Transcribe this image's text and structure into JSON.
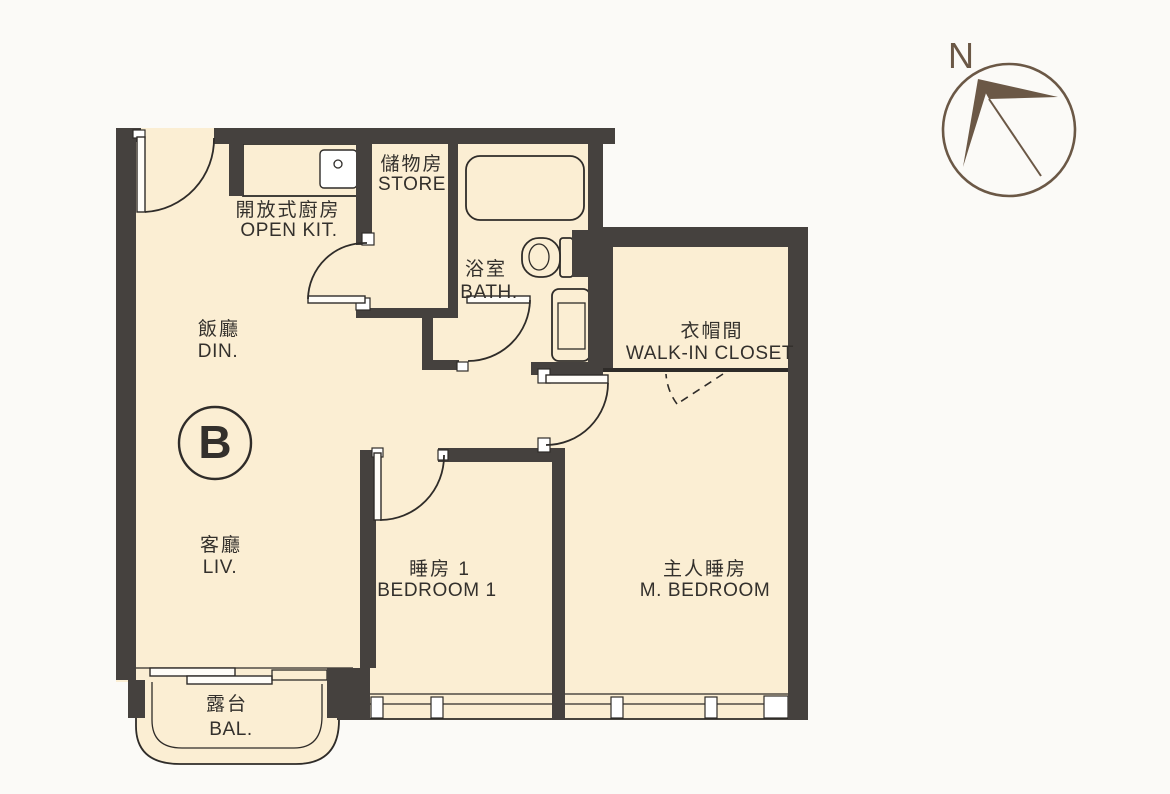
{
  "figure_type": "apartment-floor-plan",
  "unit": {
    "label": "B"
  },
  "compass": {
    "north_label": "N"
  },
  "rooms": {
    "open_kitchen": {
      "cjk": "開放式廚房",
      "en": "OPEN KIT."
    },
    "store": {
      "cjk": "儲物房",
      "en": "STORE"
    },
    "bath": {
      "cjk": "浴室",
      "en": "BATH."
    },
    "walk_in_closet": {
      "cjk": "衣帽間",
      "en": "WALK-IN CLOSET"
    },
    "dining": {
      "cjk": "飯廳",
      "en": "DIN."
    },
    "living": {
      "cjk": "客廳",
      "en": "LIV."
    },
    "bedroom1": {
      "cjk": "睡房 1",
      "en": "BEDROOM 1"
    },
    "master_bedroom": {
      "cjk": "主人睡房",
      "en": "M. BEDROOM"
    },
    "balcony": {
      "cjk": "露台",
      "en": "BAL."
    }
  },
  "colors": {
    "background": "#fbfaf7",
    "floor": "#fbeed3",
    "wall": "#45413e",
    "line": "#2f2c29",
    "text": "#33302c",
    "compass": "#6b5846"
  }
}
